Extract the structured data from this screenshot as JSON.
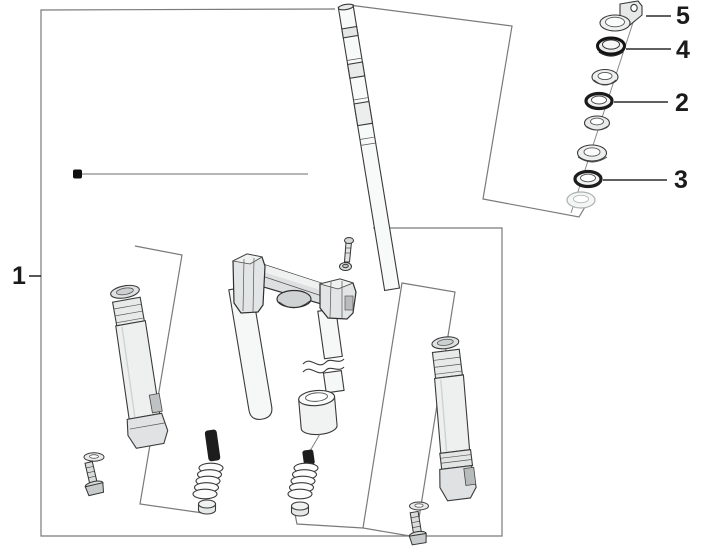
{
  "diagram": {
    "kind": "exploded-parts-diagram",
    "subject": "front-fork-and-steering-bearing-assembly",
    "background_color": "#ffffff",
    "reference_line_color": "#7a7a7a",
    "part_line_color": "#3a3a3a",
    "callouts": {
      "c1": {
        "label": "1"
      },
      "c2": {
        "label": "2"
      },
      "c3": {
        "label": "3"
      },
      "c4": {
        "label": "4"
      },
      "c5": {
        "label": "5"
      }
    }
  }
}
